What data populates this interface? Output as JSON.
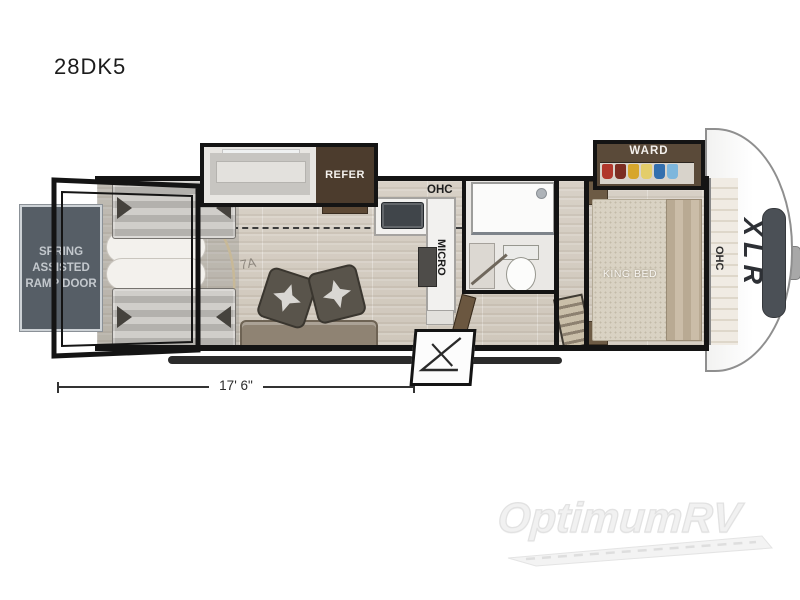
{
  "title": "28DK5",
  "plan": {
    "ramp_door_label": "SPRING ASSISTED RAMP DOOR",
    "refer_label": "REFER",
    "kitchen_ohc_label": "OHC",
    "micro_label": "MICRO",
    "floor_mark": "7A",
    "ward_label": "WARD",
    "king_bed_label": "KING BED",
    "bedroom_ohc_label": "OHC",
    "brand_label": "XLR",
    "dimension_label": "17' 6\""
  },
  "watermark": {
    "text": "OptimumRV"
  },
  "icons": {
    "ramp-door-panel": "gray-rect",
    "fold-up-bed": "striped-rect-with-arrows",
    "rolled-bed": "white-capsule",
    "theater-seat": "rotated-square-with-star",
    "refrigerator": "brown-box",
    "sink": "dark-rounded-rect",
    "cooktop": "dark-rect",
    "shower": "glass-box-with-head-dot",
    "toilet": "tank-plus-oval",
    "king-bed": "dotted-rect",
    "wardrobe-clothes": "colored-hanging-clothes",
    "front-cap-window": "dark-rounded-band",
    "hitch-pin": "gray-stub",
    "awning-rail": "dark-bar",
    "entry-steps": "outlined-box-with-diagonals",
    "watermark-road": "road-swoosh"
  },
  "colors": {
    "wall": "#141414",
    "floor_light": "#d8d1c7",
    "floor_dark": "#cfc7bb",
    "ramp_panel": "#565e66",
    "refer_box": "#4c3c2d",
    "ward_box": "#5a4a39",
    "clothes_red": "#b0372c",
    "clothes_dark_red": "#7c2d22",
    "clothes_yellow": "#d7a62b",
    "clothes_light_yellow": "#e3cd6a",
    "clothes_blue": "#336fae",
    "clothes_light_blue": "#7db6dc",
    "cap_window": "#4b5056",
    "watermark": "#f1f1f1"
  }
}
